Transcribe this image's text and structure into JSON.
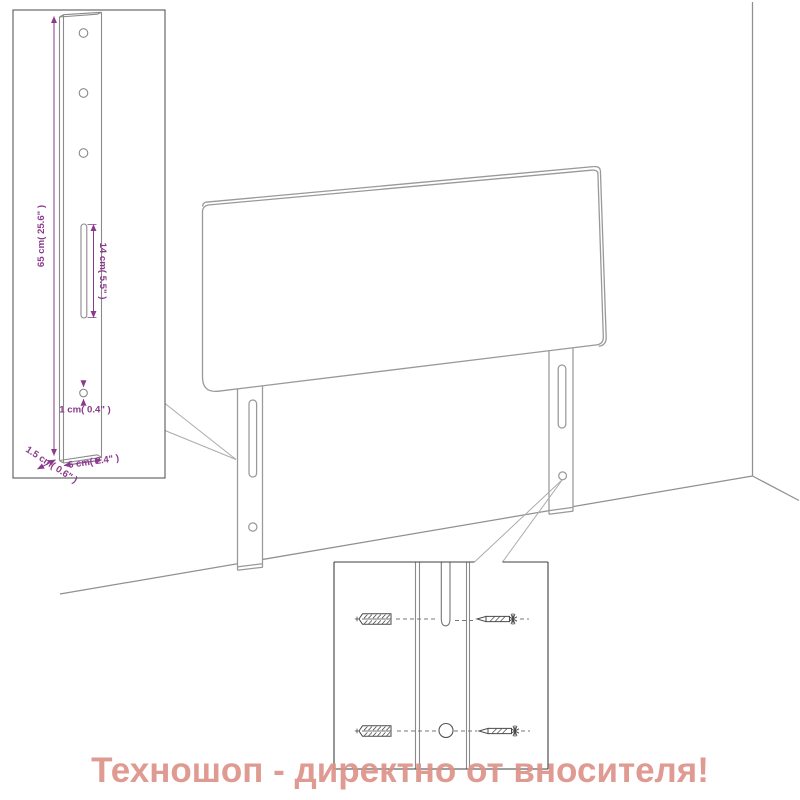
{
  "watermark": {
    "text": "Техношоп - директно от вносителя!",
    "color": "#dd9289"
  },
  "palette": {
    "dimension_color": "#8a3a8c",
    "drawing_line_color": "#979797",
    "inset_border_color": "#4a4a4a",
    "hardware_color": "#4a4a4a",
    "background": "#ffffff"
  },
  "leg_inset": {
    "height_label": "65 cm( 25.6\" )",
    "slot_label": "14 cm( 5.5\" )",
    "hole_label": "1 cm( 0.4\" )",
    "thickness_label": "1.5 cm( 0.6\" )",
    "width_label": "6 cm( 2.4\" )"
  }
}
